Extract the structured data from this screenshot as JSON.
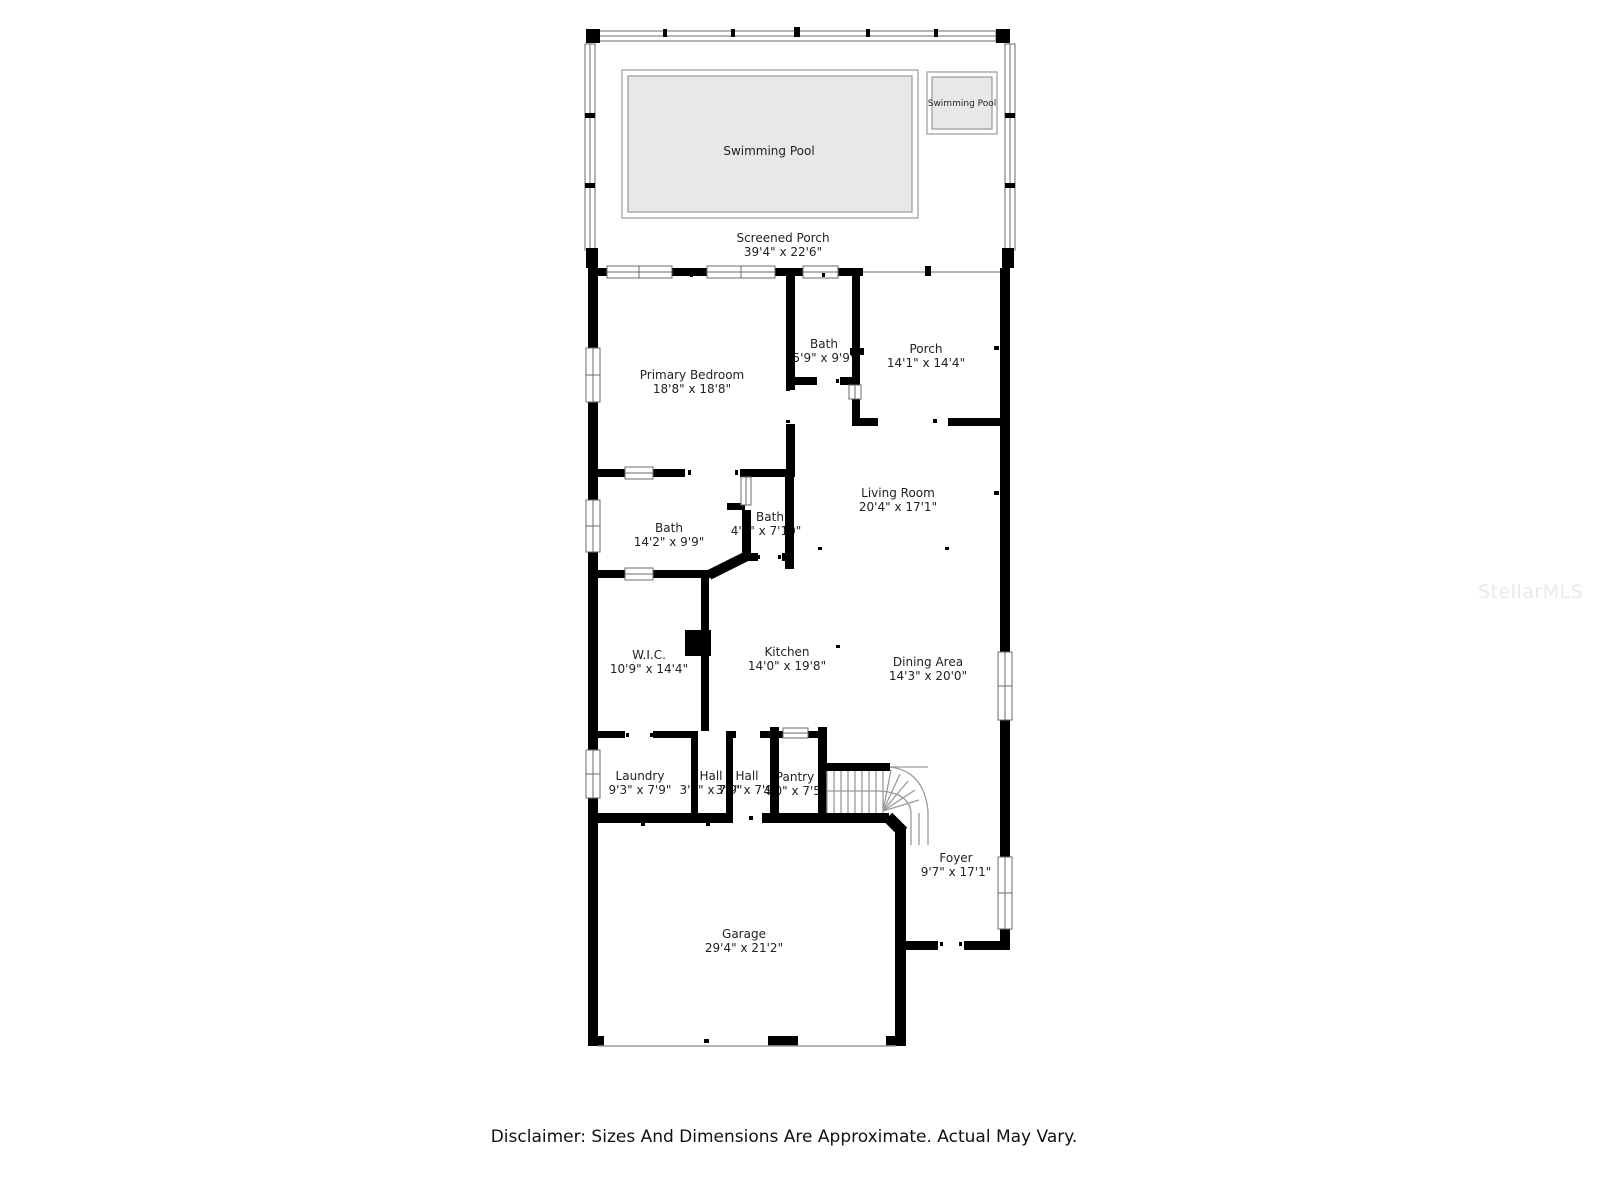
{
  "plan": {
    "watermark": "StellarMLS",
    "disclaimer": "Disclaimer: Sizes And Dimensions Are Approximate. Actual May Vary.",
    "colors": {
      "wall": "#000000",
      "pool_fill": "#e8e8e8",
      "screen_line": "#9a9a9a",
      "label_text": "#222222",
      "watermark_text": "#e9e9e9",
      "disclaimer_text": "#111111"
    },
    "rooms": [
      {
        "id": "screened-porch",
        "name": "Screened Porch",
        "dims": "39'4\" x 22'6\""
      },
      {
        "id": "swimming-pool",
        "name": "Swimming Pool",
        "dims": ""
      },
      {
        "id": "swimming-pool-2",
        "name": "Swimming Pool",
        "dims": ""
      },
      {
        "id": "primary-bedroom",
        "name": "Primary Bedroom",
        "dims": "18'8\" x 18'8\""
      },
      {
        "id": "bath-1",
        "name": "Bath",
        "dims": "5'9\" x 9'9\""
      },
      {
        "id": "porch",
        "name": "Porch",
        "dims": "14'1\" x 14'4\""
      },
      {
        "id": "living-room",
        "name": "Living Room",
        "dims": "20'4\" x 17'1\""
      },
      {
        "id": "bath-2",
        "name": "Bath",
        "dims": "14'2\" x 9'9\""
      },
      {
        "id": "bath-3",
        "name": "Bath",
        "dims": "4'1\" x 7'10\""
      },
      {
        "id": "wic",
        "name": "W.I.C.",
        "dims": "10'9\" x 14'4\""
      },
      {
        "id": "kitchen",
        "name": "Kitchen",
        "dims": "14'0\" x 19'8\""
      },
      {
        "id": "dining-area",
        "name": "Dining Area",
        "dims": "14'3\" x 20'0\""
      },
      {
        "id": "laundry",
        "name": "Laundry",
        "dims": "9'3\" x 7'9\""
      },
      {
        "id": "hall-1",
        "name": "Hall",
        "dims": "3'1\" x 7'9\""
      },
      {
        "id": "hall-2",
        "name": "Hall",
        "dims": "3'8\" x 7'9\""
      },
      {
        "id": "pantry",
        "name": "Pantry",
        "dims": "4'0\" x 7'5\""
      },
      {
        "id": "foyer",
        "name": "Foyer",
        "dims": "9'7\" x 17'1\""
      },
      {
        "id": "garage",
        "name": "Garage",
        "dims": "29'4\" x 21'2\""
      }
    ]
  }
}
